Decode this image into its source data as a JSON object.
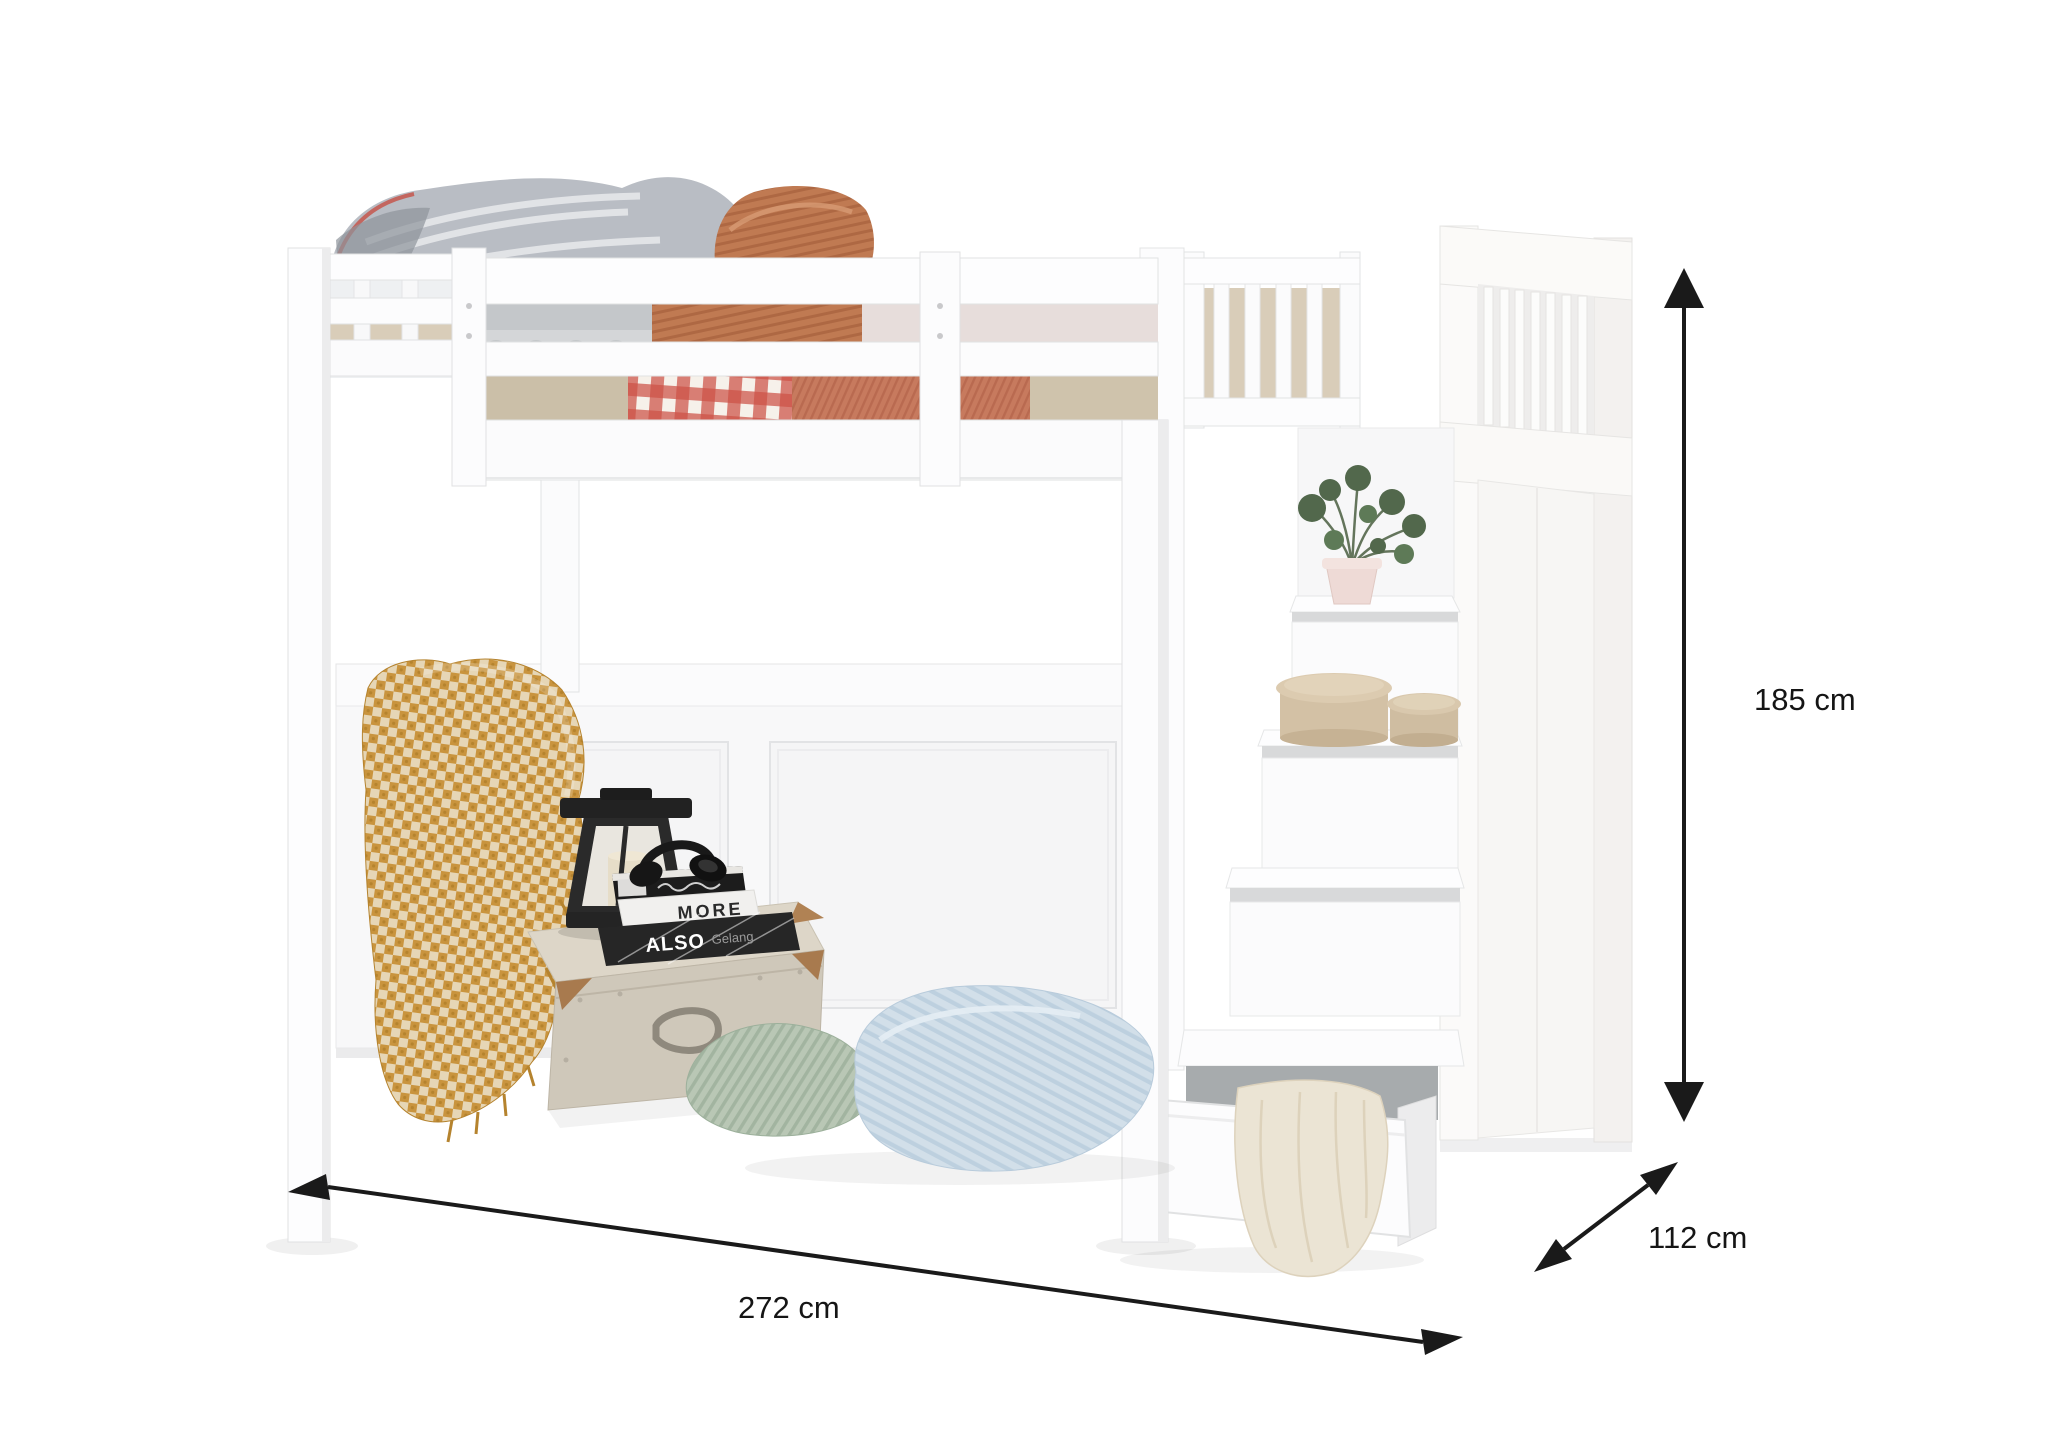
{
  "diagram": {
    "kind": "furniture-dimension-diagram",
    "background_color": "#ffffff",
    "ink_color": "#1a1a1a"
  },
  "dimensions": {
    "height": {
      "label": "185 cm",
      "arrow": "vertical-double-arrow"
    },
    "depth": {
      "label": "112 cm",
      "arrow": "diagonal-double-arrow"
    },
    "width": {
      "label": "272 cm",
      "arrow": "horizontal-double-arrow"
    }
  },
  "scene": {
    "subject": "white loft bunk bed with storage staircase, pull-out drawer and decor",
    "books": {
      "middle_title": "MORE",
      "bottom_title": "ALSO",
      "bottom_subtitle": "Gelang"
    },
    "colors": {
      "furniture_white": "#fdfdfd",
      "furniture_shade": "#ededee",
      "mustard_throw": "#c9943e",
      "gingham_red": "#cd5247",
      "terracotta_pillow": "#c07a52",
      "salmon_duvet": "#c77a5e",
      "beige_duvet": "#cbbfa8",
      "gray_duvet": "#b9bdc4",
      "blush_bedding": "#e7dddb",
      "sage_pillow": "#b9c7b5",
      "blue_pillow": "#d2dfe9",
      "cream_blanket": "#ebe4d4",
      "hatbox_beige": "#d3c1a5",
      "plant_green": "#52684c",
      "pot_pink": "#eedad6",
      "lantern_black": "#2a2a2a",
      "trunk_greige": "#cfc8ba"
    }
  }
}
